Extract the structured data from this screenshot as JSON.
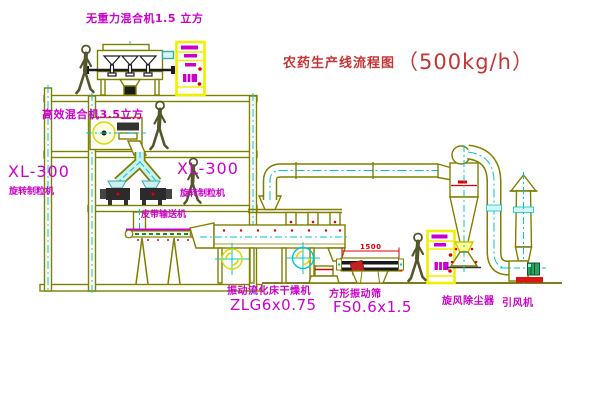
{
  "diagram": {
    "type": "process-flow-diagram",
    "title_cn": "农药生产线流程图",
    "title_capacity": "（500kg/h）"
  },
  "equipment_labels": {
    "gravity_mixer": "无重力混合机1.5 立方",
    "high_eff_mixer": "高效混合机3.5立方",
    "granulator_left_model": "XL-300",
    "granulator_left_name": "旋转制粒机",
    "granulator_right_model": "XL-300",
    "granulator_right_name": "旋转制粒机",
    "belt_conveyor": "皮带输送机",
    "dryer_name": "振动流化床干燥机",
    "dryer_model": "ZLG6x0.75",
    "sieve_name": "方形振动筛",
    "sieve_model": "FS0.6x1.5",
    "cyclone": "旋风除尘器",
    "fan": "引风机"
  },
  "dimensions": {
    "sieve_width": "1500"
  },
  "colors": {
    "structure_olive": "#7f7f00",
    "centerline_cyan": "#00c8c8",
    "label_magenta": "#cc00cc",
    "title_red": "#c53535",
    "dimension_red": "#e00000",
    "cabinet_yellow": "#f0f000",
    "motor_green": "#28a45c",
    "detail_black": "#1c1c1c"
  }
}
